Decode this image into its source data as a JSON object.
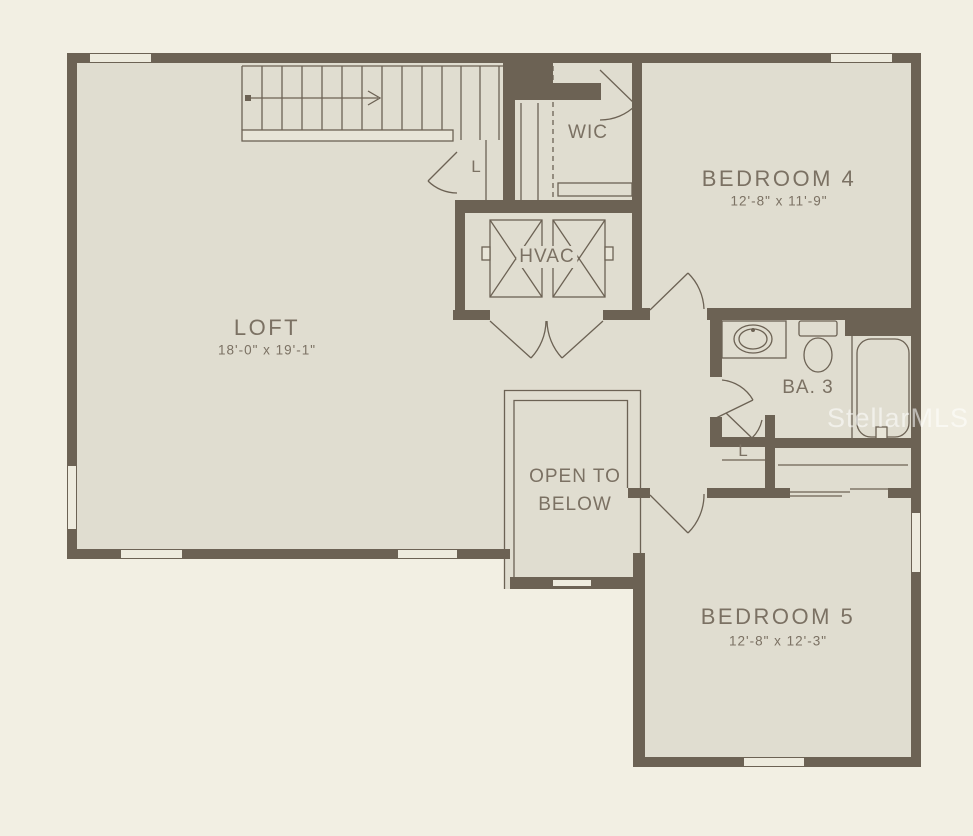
{
  "rooms": {
    "loft": {
      "label": "LOFT",
      "dims": "18'-0\" x 19'-1\""
    },
    "wic": {
      "label": "WIC"
    },
    "linen_stairs": {
      "label": "L"
    },
    "hvac": {
      "label": "HVAC"
    },
    "bedroom4": {
      "label": "BEDROOM 4",
      "dims": "12'-8\" x 11'-9\""
    },
    "bath3": {
      "label": "BA. 3"
    },
    "linen_bath": {
      "label": "L"
    },
    "open_to_below": {
      "line1": "OPEN TO",
      "line2": "BELOW"
    },
    "bedroom5": {
      "label": "BEDROOM 5",
      "dims": "12'-8\" x 12'-3\""
    }
  },
  "watermark": {
    "text": "StellarMLS"
  },
  "colors": {
    "background": "#f2efe3",
    "floor": "#e0ddd0",
    "wall": "#6c6254",
    "label_text": "#7b7163",
    "window_fill": "#eeebde",
    "watermark": "rgba(255,255,255,0.55)"
  }
}
